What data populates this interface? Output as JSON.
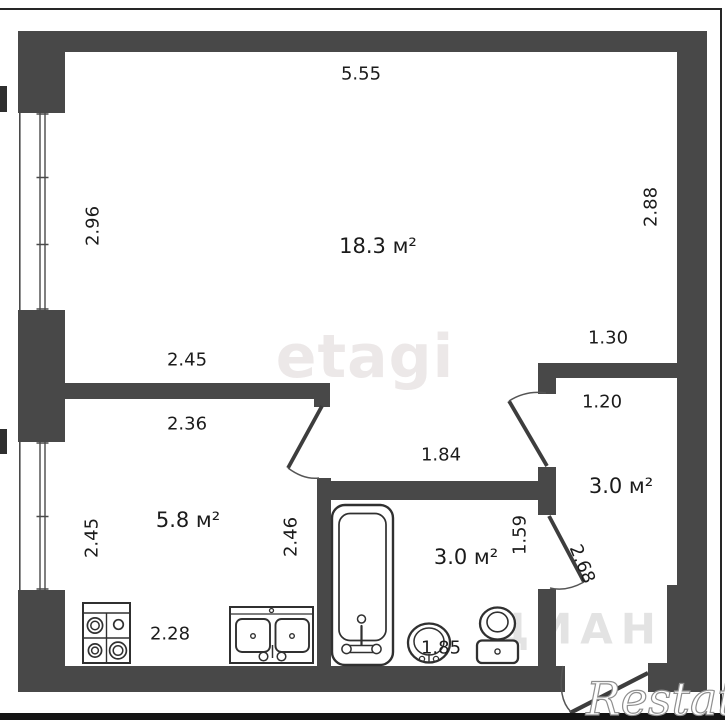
{
  "plan": {
    "type": "apartment-floor-plan",
    "rooms": {
      "living": {
        "label": "18.3 м²"
      },
      "kitchen": {
        "label": "5.8 м²"
      },
      "bathroom": {
        "label": "3.0 м²"
      },
      "hallway": {
        "label": "3.0 м²"
      }
    },
    "dims": {
      "top_width": "5.55",
      "living_left_height": "2.96",
      "living_right_height": "2.88",
      "kitchen_wall_top": "2.45",
      "kitchen_wall_bottom": "2.36",
      "hall_top_width": "1.30",
      "hall_inner_width": "1.20",
      "corridor_width": "1.84",
      "kitchen_left_height": "2.45",
      "kitchen_right_height": "2.46",
      "kitchen_bottom_width": "2.28",
      "bath_right_height": "1.59",
      "hall_height": "2.68",
      "bath_bottom_width": "1.85"
    },
    "fixtures": [
      "stove-icon",
      "kitchen-sink-icon",
      "bathtub-icon",
      "wash-basin-icon",
      "toilet-icon"
    ],
    "windows": 2,
    "doors": 4
  },
  "watermarks": {
    "brand_center": "etagi",
    "brand_corner": "Restate",
    "brand_small": "ЦИАН"
  },
  "colors": {
    "wall": "#484848",
    "dimension_text": "#1c1c1c",
    "watermark_center": "#ece8e8",
    "watermark_small": "#e3e3e3",
    "frame": "#262626"
  }
}
